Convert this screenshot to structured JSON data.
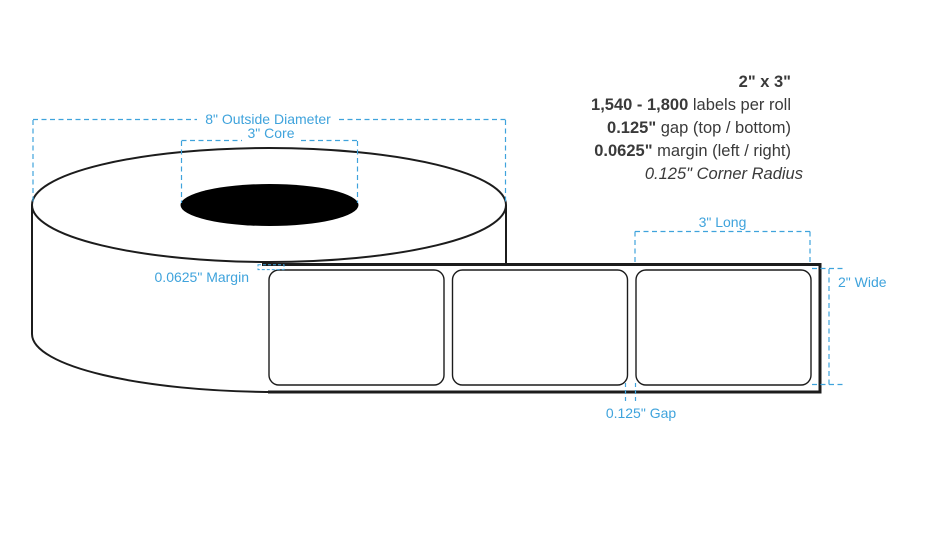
{
  "title": "2 x 3 inch label roll specification diagram",
  "colors": {
    "outline": "#1c1c1c",
    "dimension_blue": "#3fa3dc",
    "spec_text": "#3a3a3a",
    "core_fill": "#000000",
    "label_fill": "#ffffff"
  },
  "specs": {
    "size": "2\" x 3\"",
    "labels_per_roll_bold": "1,540 - 1,800",
    "labels_per_roll_rest": " labels per roll",
    "gap_bold": "0.125\"",
    "gap_rest": " gap (top / bottom)",
    "margin_bold": "0.0625\"",
    "margin_rest": " margin (left / right)",
    "corner_radius": "0.125\" Corner Radius"
  },
  "dimensions": {
    "outside_diameter": "8\" Outside Diameter",
    "core": "3\" Core",
    "margin": "0.0625\" Margin",
    "long": "3\" Long",
    "wide": "2\" Wide",
    "gap": "0.125\" Gap"
  }
}
